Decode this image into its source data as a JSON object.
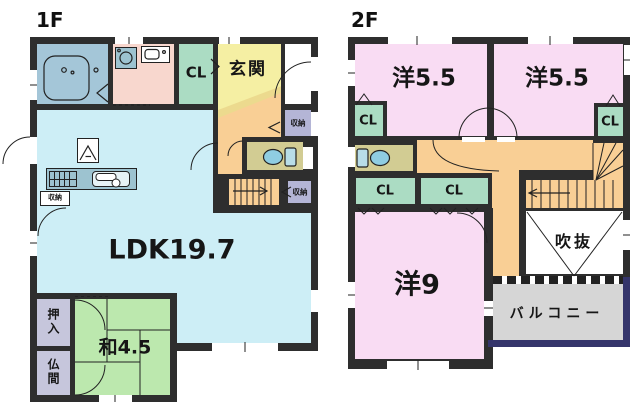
{
  "plan": {
    "floor1": {
      "title": "1F",
      "labels": {
        "cl": "CL",
        "genkan": "玄関",
        "storage_a": "収納",
        "storage_b": "収納",
        "storage_kitchen": "収納",
        "ldk": "LDK19.7",
        "washitsu": "和4.5",
        "oshiire": "押入",
        "butsuma": "仏間"
      }
    },
    "floor2": {
      "title": "2F",
      "labels": {
        "room_a": "洋5.5",
        "room_b": "洋5.5",
        "room_c": "洋9",
        "cl_a": "CL",
        "cl_b": "CL",
        "cl_c": "CL",
        "cl_d": "CL",
        "fukinuke": "吹抜",
        "balcony": "バルコニー"
      }
    },
    "colors": {
      "wall": "#2e2e2e",
      "bathroom": "#a4c6d8",
      "washroom": "#f8d7ce",
      "closet_green": "#abdcc3",
      "genkan_yellow": "#f5efa3",
      "genkan_step": "#ecda8e",
      "hall_orange": "#f9cf95",
      "storage_purple": "#b4b5d6",
      "toilet_tan": "#d2cc93",
      "ldk_cyan": "#cdeef6",
      "tatami_green": "#bce8ae",
      "oshiire_gray": "#c6c6dc",
      "western_pink": "#f9dcf3",
      "balcony_gray": "#d6d6d6",
      "balcony_edge_navy": "#35356b",
      "counter_teal": "#9dc3d0",
      "fixture_blue": "#a9d9ea",
      "background": "#ffffff"
    }
  }
}
